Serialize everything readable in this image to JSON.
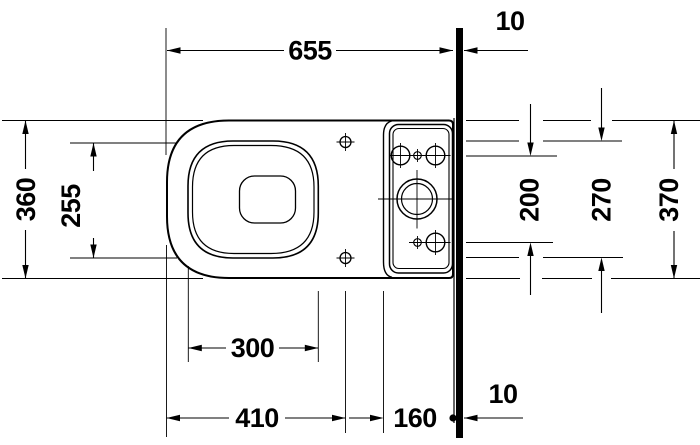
{
  "drawing": {
    "dimensions": {
      "total_length": "655",
      "wall_thickness_top": "10",
      "total_width": "360",
      "bowl_rim_width": "255",
      "fixing_holes_spacing": "200",
      "cistern_inner_width": "270",
      "cistern_total_width": "370",
      "bowl_rim_length": "300",
      "front_to_seat_fixing": "410",
      "cistern_depth_to_wall": "160",
      "wall_thickness_bottom": "10"
    }
  }
}
